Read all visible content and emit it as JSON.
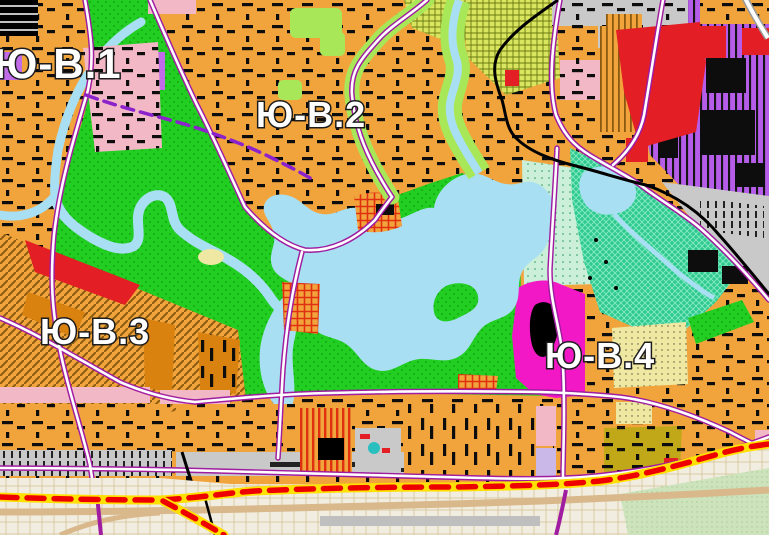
{
  "map": {
    "districts": [
      {
        "id": "yv1",
        "label": "Ю-В.1"
      },
      {
        "id": "yv2",
        "label": "Ю-В.2"
      },
      {
        "id": "yv3",
        "label": "Ю-В.3"
      },
      {
        "id": "yv4",
        "label": "Ю-В.4"
      }
    ],
    "colors": {
      "residential": "#F2A43C",
      "residential_dark": "#D9820F",
      "buildings": "#0d0d0d",
      "park": "#21CE21",
      "park_dot": "#0E9E0E",
      "water": "#A8DFF2",
      "light_green": "#A8E858",
      "allotment": "#D9E45F",
      "allotment_line": "#6a7a10",
      "industrial_violet": "#B55CE8",
      "violet_patch": "#C06CE8",
      "lavender": "#C9B8E8",
      "special_magenta": "#F318C5",
      "red_zone": "#E31E24",
      "pink_zone": "#F2B8C6",
      "grey_zone": "#C9C9C9",
      "teal_park": "#2EC98E",
      "teal_hatch": "#7FE8C0",
      "mint": "#CBEFD8",
      "pale_yellow": "#EFE8A2",
      "olive": "#C0A818",
      "checker_red": "#E03010",
      "hatch_brown": "#8a5a10",
      "road_border": "#A01CA0",
      "road_fill": "#FFFFFF",
      "metro_dash": "#8B22CC",
      "railway": "#000000",
      "boundary_band": "#FFE000",
      "boundary_dash": "#EE0000",
      "outside": "#F1EEE1",
      "outside_grid": "#D9C9A4",
      "outside_green": "#CDE3BC",
      "outside_road": "#D9B98C",
      "teal_blob": "#2ABFBF"
    }
  }
}
